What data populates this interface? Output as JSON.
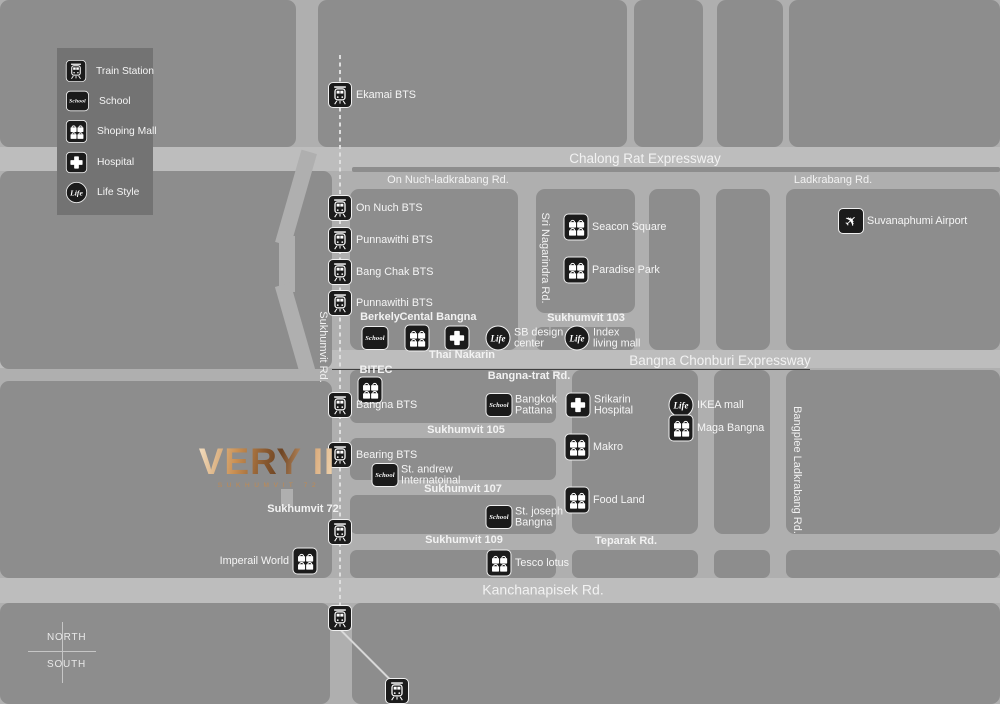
{
  "colors": {
    "block": "#8d8d8d",
    "road": "#afafaf",
    "road_major": "#bdbdbd",
    "legend_panel": "#737373",
    "icon_bg": "#1b1b1b",
    "label_text": "#f5f5f5",
    "logo_gold": "#c08a52"
  },
  "logo": {
    "title": "VERY II",
    "subtitle": "SUKHUMVIT 72"
  },
  "compass": {
    "north": "NORTH",
    "south": "SOUTH"
  },
  "icons": {
    "school_text": "School",
    "life_text": "Life",
    "airplane": "✈"
  },
  "legend": {
    "items": [
      {
        "type": "train",
        "label": "Train Station"
      },
      {
        "type": "school",
        "label": "School"
      },
      {
        "type": "mall",
        "label": "Shoping Mall"
      },
      {
        "type": "hospital",
        "label": "Hospital"
      },
      {
        "type": "life",
        "label": "Life Style"
      }
    ]
  },
  "map": {
    "road_labels": [
      {
        "text": "Chalong Rat Expressway",
        "x": 645,
        "y": 159,
        "size": 13.5,
        "bold": false,
        "rot": 0
      },
      {
        "text": "On Nuch-ladkrabang Rd.",
        "x": 448,
        "y": 181,
        "size": 11,
        "bold": false,
        "rot": 0
      },
      {
        "text": "Ladkrabang Rd.",
        "x": 833,
        "y": 181,
        "size": 11,
        "bold": false,
        "rot": 0
      },
      {
        "text": "Sukhumvit 103",
        "x": 586,
        "y": 319,
        "size": 11,
        "bold": true,
        "rot": 0
      },
      {
        "text": "Thai Nakarin",
        "x": 462,
        "y": 356,
        "size": 11,
        "bold": true,
        "rot": 0
      },
      {
        "text": "Bangna Chonburi Expressway",
        "x": 720,
        "y": 361,
        "size": 13.5,
        "bold": false,
        "rot": 0
      },
      {
        "text": "Bangna-trat Rd.",
        "x": 529,
        "y": 377,
        "size": 11,
        "bold": true,
        "rot": 0
      },
      {
        "text": "BITEC",
        "x": 376,
        "y": 371,
        "size": 11,
        "bold": true,
        "rot": 0
      },
      {
        "text": "Berkely",
        "x": 380,
        "y": 318,
        "size": 11,
        "bold": true,
        "rot": 0
      },
      {
        "text": "Cental Bangna",
        "x": 438,
        "y": 318,
        "size": 11,
        "bold": true,
        "rot": 0
      },
      {
        "text": "Sukhumvit 105",
        "x": 466,
        "y": 431,
        "size": 11,
        "bold": true,
        "rot": 0
      },
      {
        "text": "Sukhumvit 107",
        "x": 463,
        "y": 490,
        "size": 11,
        "bold": true,
        "rot": 0
      },
      {
        "text": "Sukhumvit 109",
        "x": 464,
        "y": 541,
        "size": 11,
        "bold": true,
        "rot": 0
      },
      {
        "text": "Teparak Rd.",
        "x": 626,
        "y": 542,
        "size": 11,
        "bold": true,
        "rot": 0
      },
      {
        "text": "Kanchanapisek Rd.",
        "x": 543,
        "y": 590,
        "size": 14,
        "bold": false,
        "rot": 0
      },
      {
        "text": "Sukhumvit 72",
        "x": 303,
        "y": 510,
        "size": 11,
        "bold": true,
        "rot": 0
      },
      {
        "text": "Sukhumvit Rd.",
        "x": 322,
        "y": 347,
        "size": 11,
        "bold": false,
        "rot": 90
      },
      {
        "text": "Sri Nagarindra Rd.",
        "x": 544,
        "y": 258,
        "size": 11,
        "bold": false,
        "rot": 90
      },
      {
        "text": "Bangplee Ladkrabang Rd.",
        "x": 796,
        "y": 470,
        "size": 11,
        "bold": false,
        "rot": 90
      }
    ],
    "pois": [
      {
        "type": "train",
        "lines": [
          "Ekamai BTS"
        ],
        "x": 340,
        "y": 95
      },
      {
        "type": "train",
        "lines": [
          "On Nuch BTS"
        ],
        "x": 340,
        "y": 208
      },
      {
        "type": "train",
        "lines": [
          "Punnawithi BTS"
        ],
        "x": 340,
        "y": 240
      },
      {
        "type": "train",
        "lines": [
          "Bang Chak BTS"
        ],
        "x": 340,
        "y": 272
      },
      {
        "type": "train",
        "lines": [
          "Punnawithi BTS"
        ],
        "x": 340,
        "y": 303
      },
      {
        "type": "school",
        "lines": [],
        "x": 375,
        "y": 338
      },
      {
        "type": "mall",
        "lines": [],
        "x": 417,
        "y": 338
      },
      {
        "type": "hospital",
        "lines": [],
        "x": 457,
        "y": 338
      },
      {
        "type": "life",
        "lines": [
          "SB design",
          "center"
        ],
        "x": 498,
        "y": 338
      },
      {
        "type": "life",
        "lines": [
          "Index",
          "living mall"
        ],
        "x": 577,
        "y": 338
      },
      {
        "type": "mall",
        "lines": [
          "Seacon Square"
        ],
        "x": 576,
        "y": 227
      },
      {
        "type": "mall",
        "lines": [
          "Paradise Park"
        ],
        "x": 576,
        "y": 270
      },
      {
        "type": "airport",
        "lines": [
          "Suvanaphumi Airport"
        ],
        "x": 851,
        "y": 221
      },
      {
        "type": "mall",
        "lines": [],
        "x": 370,
        "y": 390
      },
      {
        "type": "train",
        "lines": [
          "Bangna BTS"
        ],
        "x": 340,
        "y": 405
      },
      {
        "type": "school",
        "lines": [
          "Bangkok",
          "Pattana"
        ],
        "x": 499,
        "y": 405
      },
      {
        "type": "hospital",
        "lines": [
          "Srikarin",
          "Hospital"
        ],
        "x": 578,
        "y": 405
      },
      {
        "type": "life",
        "lines": [
          "IKEA mall"
        ],
        "x": 681,
        "y": 405
      },
      {
        "type": "mall",
        "lines": [
          "Maga Bangna"
        ],
        "x": 681,
        "y": 428
      },
      {
        "type": "mall",
        "lines": [
          "Makro"
        ],
        "x": 577,
        "y": 447
      },
      {
        "type": "mall",
        "lines": [
          "Food Land"
        ],
        "x": 577,
        "y": 500
      },
      {
        "type": "train",
        "lines": [
          "Bearing BTS"
        ],
        "x": 340,
        "y": 455
      },
      {
        "type": "school",
        "lines": [
          "St. andrew",
          "Internatoinal"
        ],
        "x": 385,
        "y": 475
      },
      {
        "type": "school",
        "lines": [
          "St. joseph",
          "Bangna"
        ],
        "x": 499,
        "y": 517
      },
      {
        "type": "mall",
        "lines": [
          "Tesco lotus"
        ],
        "x": 499,
        "y": 563
      },
      {
        "type": "mall",
        "lines": [
          "Imperail World"
        ],
        "x": 305,
        "y": 561,
        "side": "left"
      },
      {
        "type": "train",
        "lines": [],
        "x": 340,
        "y": 532
      },
      {
        "type": "train",
        "lines": [],
        "x": 340,
        "y": 618
      },
      {
        "type": "train",
        "lines": [],
        "x": 397,
        "y": 691
      }
    ]
  }
}
